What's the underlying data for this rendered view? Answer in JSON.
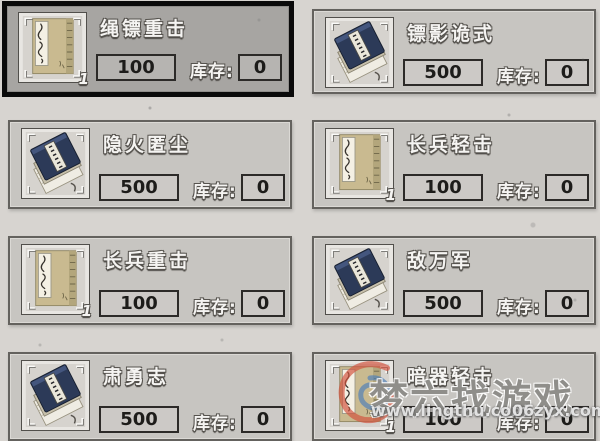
{
  "shop": {
    "stock_label": "库存:",
    "cards": [
      {
        "title": "绳镖重击",
        "price": "100",
        "stock": "0",
        "icon": "tan-book-icon",
        "count": "1",
        "selected": true
      },
      {
        "title": "镖影诡式",
        "price": "500",
        "stock": "0",
        "icon": "blue-book-stack-icon",
        "selected": false
      },
      {
        "title": "隐火匿尘",
        "price": "500",
        "stock": "0",
        "icon": "blue-book-stack-icon",
        "selected": false
      },
      {
        "title": "长兵轻击",
        "price": "100",
        "stock": "0",
        "icon": "tan-book-icon",
        "count": "1",
        "selected": false
      },
      {
        "title": "长兵重击",
        "price": "100",
        "stock": "0",
        "icon": "tan-book-icon",
        "count": "1",
        "selected": false
      },
      {
        "title": "敌万军",
        "price": "500",
        "stock": "0",
        "icon": "blue-book-stack-icon",
        "selected": false
      },
      {
        "title": "肃勇志",
        "price": "500",
        "stock": "0",
        "icon": "blue-book-stack-icon",
        "selected": false
      },
      {
        "title": "暗器轻击",
        "price": "100",
        "stock": "0",
        "icon": "tan-book-icon",
        "count": "1",
        "selected": false
      }
    ],
    "colors": {
      "page_bg": "#d7d4d0",
      "card_bg": "#c7c5c1",
      "selected_card_bg": "#a7a5a2",
      "selected_border": "#0a0a0a",
      "box_border": "#2c2a28",
      "tan_book_cover": "#c9ba90",
      "blue_book_cover": "#2c3a58"
    }
  },
  "watermark": {
    "site_name": "梦六找游戏",
    "url_left": "www.lingthu.com",
    "url_right": "06zyx.com",
    "logo": "swirl-logo-icon",
    "logo_red": "#d2543e",
    "logo_blue": "#4f80b8"
  }
}
